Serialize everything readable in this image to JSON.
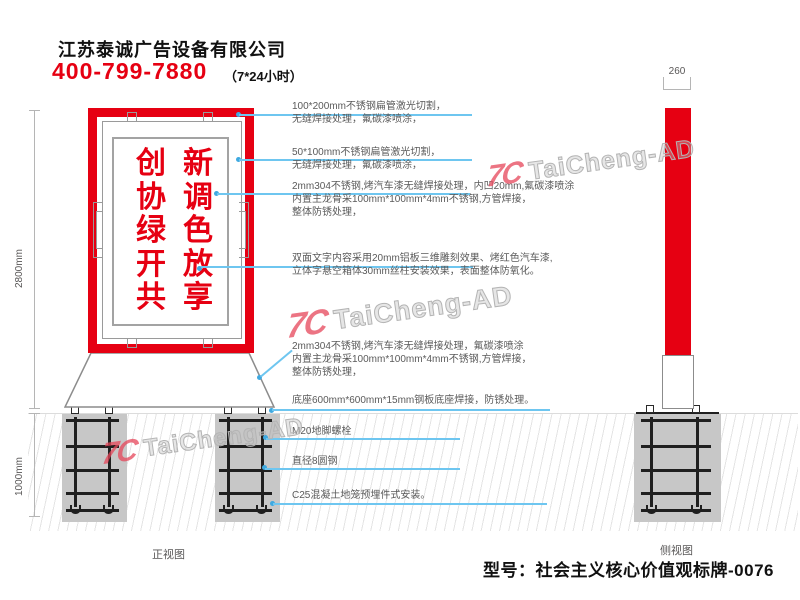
{
  "header": {
    "company": "江苏泰诚广告设备有限公司",
    "phone": "400-799-7880",
    "hours": "（7*24小时）"
  },
  "watermark": {
    "logo": "7C",
    "text": "TaiCheng-AD"
  },
  "front_view": {
    "label": "正视图",
    "dim_above_ground": "2800mm",
    "dim_below_ground": "1000mm",
    "sign_columns": [
      [
        "创",
        "协",
        "绿",
        "开",
        "共"
      ],
      [
        "新",
        "调",
        "色",
        "放",
        "享"
      ]
    ]
  },
  "side_view": {
    "label": "侧视图",
    "dim_width": "260"
  },
  "annotations": [
    {
      "lines": [
        "100*200mm不锈钢扁管激光切割，",
        "无缝焊接处理，氟碳漆喷涂，"
      ]
    },
    {
      "lines": [
        "50*100mm不锈钢扁管激光切割，",
        "无缝焊接处理，氟碳漆喷涂，"
      ]
    },
    {
      "lines": [
        "2mm304不锈钢,烤汽车漆无缝焊接处理，内凹20mm,氟碳漆喷涂",
        "内置主龙骨采100mm*100mm*4mm不锈钢,方管焊接，",
        "整体防锈处理，"
      ]
    },
    {
      "lines": [
        "双面文字内容采用20mm铝板三维雕刻效果、烤红色汽车漆,",
        "立体字悬空箱体30mm丝柱安装效果，表面整体防氧化。"
      ]
    },
    {
      "lines": [
        "2mm304不锈钢,烤汽车漆无缝焊接处理，氟碳漆喷涂",
        "内置主龙骨采100mm*100mm*4mm不锈钢,方管焊接，",
        "整体防锈处理，"
      ]
    },
    {
      "lines": [
        "底座600mm*600mm*15mm钢板底座焊接，防锈处理。"
      ]
    },
    {
      "lines": [
        "M20地脚螺栓"
      ]
    },
    {
      "lines": [
        "直径8圆钢"
      ]
    },
    {
      "lines": [
        "C25混凝土地笼预埋件式安装。"
      ]
    }
  ],
  "footer": {
    "model": "型号：社会主义核心价值观标牌-0076"
  },
  "colors": {
    "accent_red": "#e60012",
    "leader_blue": "#6ec6f0",
    "steel_gray": "#c7c7c7"
  }
}
